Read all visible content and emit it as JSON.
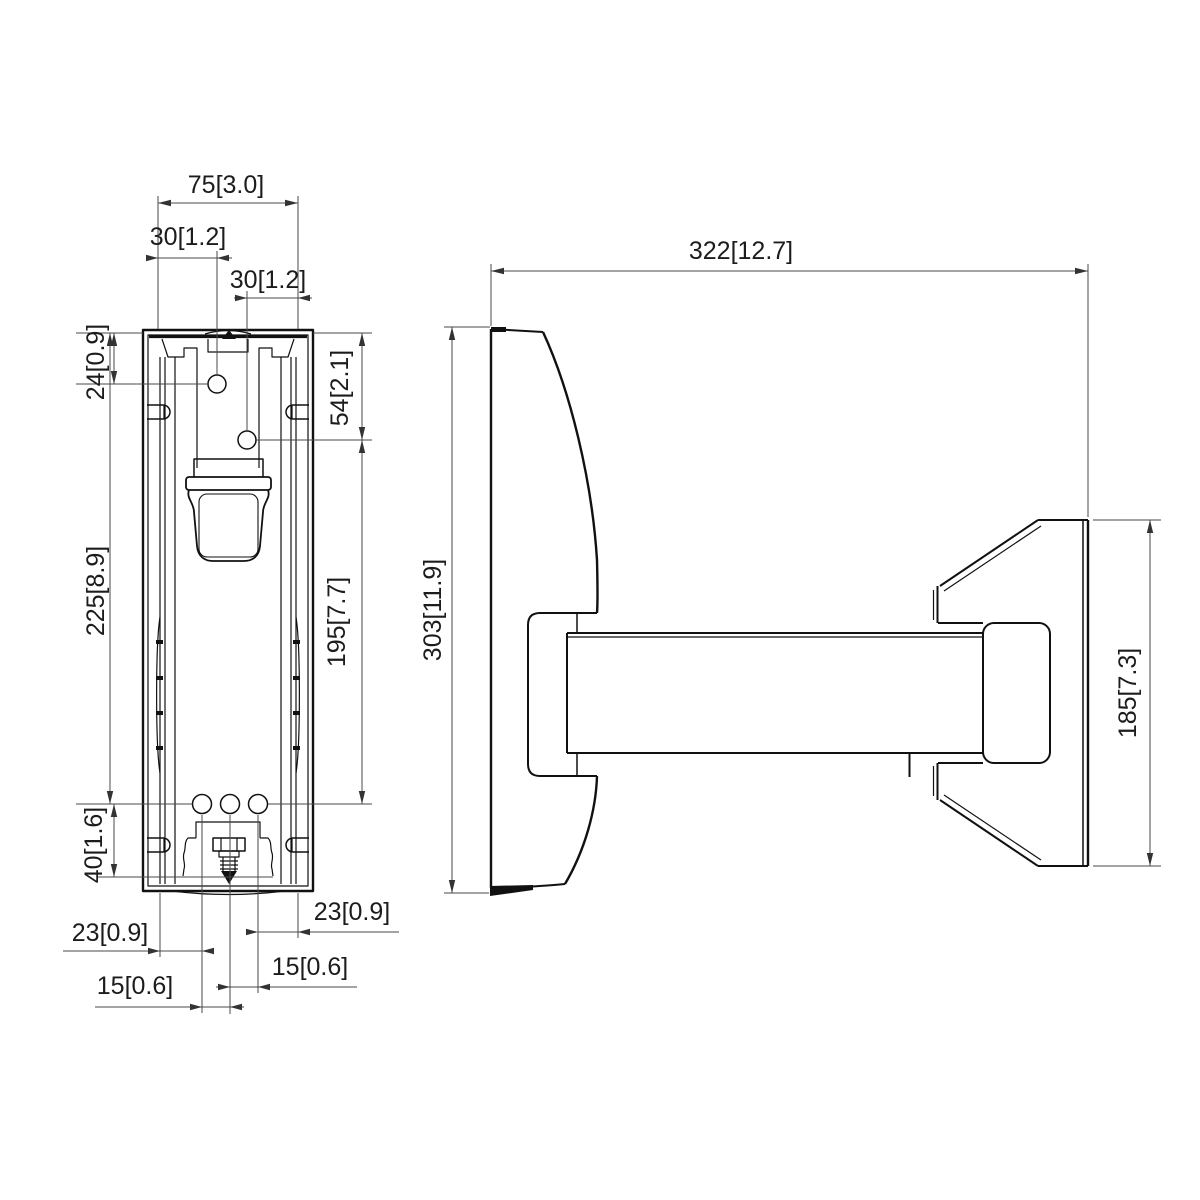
{
  "drawing": {
    "front_view": {
      "dim_top_width": "75[3.0]",
      "dim_hole1_offset": "30[1.2]",
      "dim_hole2_offset": "30[1.2]",
      "dim_hole1_depth": "24[0.9]",
      "dim_plate_height": "225[8.9]",
      "dim_bottom_offset": "40[1.6]",
      "dim_hole2_depth": "54[2.1]",
      "dim_hole_span": "195[7.7]",
      "dim_bottom_left_23": "23[0.9]",
      "dim_bottom_right_23": "23[0.9]",
      "dim_bottom_left_15": "15[0.6]",
      "dim_bottom_right_15": "15[0.6]"
    },
    "side_view": {
      "dim_depth": "322[12.7]",
      "dim_wall_plate_height": "303[11.9]",
      "dim_bracket_height": "185[7.3]"
    },
    "colors": {
      "background": "#ffffff",
      "geometry_line": "#111111",
      "dimension_line": "#4a4a4a",
      "text": "#1c1c1c"
    }
  }
}
